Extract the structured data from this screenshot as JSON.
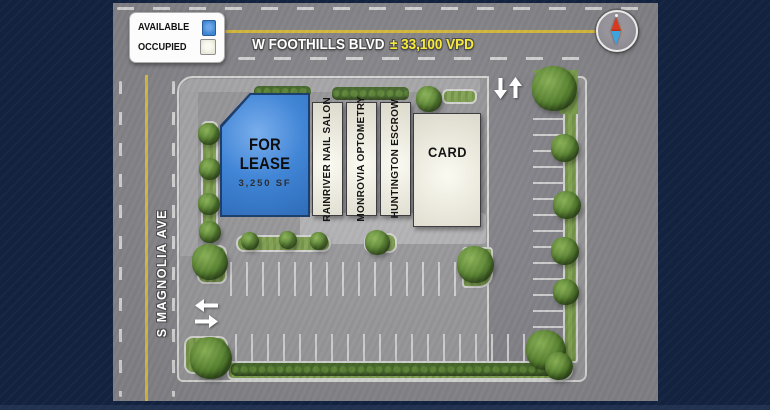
{
  "map": {
    "legend": {
      "items": [
        {
          "label": "AVAILABLE",
          "color": "#3f86d2"
        },
        {
          "label": "OCCUPIED",
          "color": "#e9e7d8"
        }
      ]
    },
    "streets": {
      "top": {
        "name": "W FOOTHILLS BLVD",
        "traffic": "± 33,100 VPD"
      },
      "left": {
        "name": "S MAGNOLIA AVE"
      }
    },
    "units": [
      {
        "name": "FOR LEASE",
        "size": "3,250 SF",
        "status": "available"
      },
      {
        "name": "RAINRIVER NAIL SALON",
        "status": "occupied"
      },
      {
        "name": "MONROVIA OPTOMETRY",
        "status": "occupied"
      },
      {
        "name": "HUNTINGTON ESCROW",
        "status": "occupied"
      },
      {
        "name": "CARD",
        "status": "occupied"
      }
    ],
    "colors": {
      "frame": "#13233f",
      "road": "#86868b",
      "lot": "#98989b",
      "available_blue": "#3f86d2",
      "occupied_cream": "#eae8dc",
      "landscape_green": "#7da04b",
      "road_yellow_line": "#d9bc3c",
      "label_yellow": "#f6e93c"
    }
  }
}
